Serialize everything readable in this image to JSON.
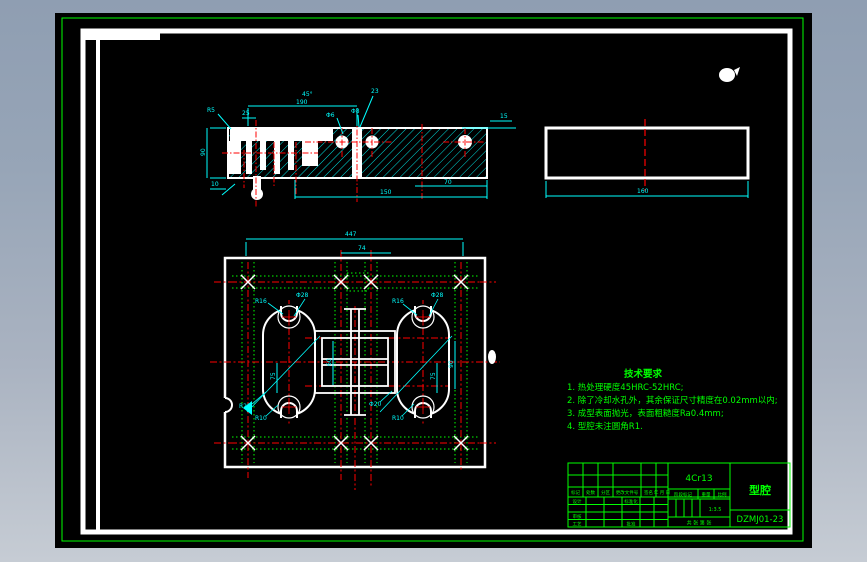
{
  "window": {
    "bg_top": "#8f9eb2",
    "bg_bottom": "#c6ccd4",
    "canvas_color": "#000000",
    "frame_color": "#00ff00",
    "geometry_color": "#ffffff",
    "dimension_color": "#00ffff",
    "centerline_color": "#ff0000"
  },
  "drawing": {
    "tech_requirements": {
      "title": "技术要求",
      "items": [
        "1. 热处理硬度45HRC-52HRC;",
        "2. 除了冷却水孔外，其余保证尺寸精度在0.02mm以内;",
        "3. 成型表面抛光，表面粗糙度Ra0.4mm;",
        "4. 型腔未注圆角R1."
      ]
    },
    "title_block": {
      "material": "4Cr13",
      "part_name": "型腔",
      "drawing_number": "DZMJ01-23",
      "scale": "1:3.5",
      "rev_header": [
        "标记",
        "处数",
        "分区",
        "更改文件号",
        "签名",
        "年 月 日"
      ],
      "left_rows": [
        "设计",
        "审核",
        "工艺"
      ],
      "mid_labels": [
        "标准化",
        "批准"
      ],
      "stage_cells": [
        "阶段标记",
        "重量",
        "比例"
      ],
      "sheet": "共 张 第 张"
    },
    "dims": {
      "sec_top": "190",
      "sec_top_small": "25",
      "sec_angle": "45°",
      "sec_depth": "23",
      "sec_phi_a": "Φ6",
      "sec_phi_b": "Φ8",
      "sec_left_h": "90",
      "sec_lead": "R5",
      "sec_chamfer": "15",
      "sec_bottom": "150",
      "sec_bottom_r": "70",
      "sec_bottom_l": "10",
      "side_w": "160",
      "plan_w": "447",
      "plan_mid": "74",
      "plan_v75": "75",
      "plan_v60": "60",
      "plan_v90": "90",
      "r16": "R16",
      "phi28": "Φ28",
      "r25": "R25",
      "r10": "R10",
      "phi20": "Φ20"
    }
  }
}
